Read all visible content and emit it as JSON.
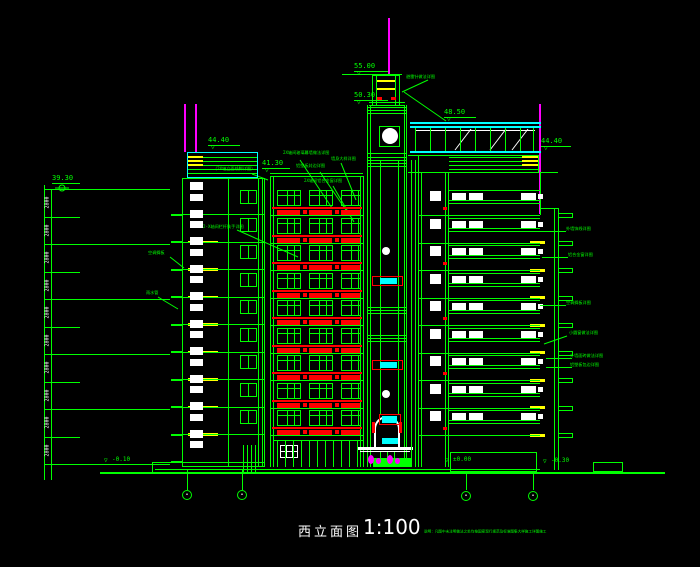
{
  "title": {
    "name": "西立面图",
    "scale": "1:100",
    "note": "说明：凡图中未注明做法之处均按国家现行规范及标准图集大样施工详图施工"
  },
  "levels": {
    "antenna_top": "55.00",
    "tower_roof": "50.30",
    "canopy": "48.50",
    "parapet_left": "44.40",
    "parapet_right": "44.40",
    "facade_top": "41.30",
    "ruler_top": "39.30",
    "ground": "±0.00",
    "plinth": "-0.10",
    "site": "-0.30"
  },
  "dims": {
    "floor_height": "2800"
  },
  "symbols": {
    "level_mark": "▽"
  },
  "grid_bubbles": [
    "•",
    "•",
    "•",
    "•"
  ],
  "annotations": {
    "tower": [
      "避雷针做法详图"
    ],
    "left": [
      "2X轴间玻璃幕墙做法详图",
      "墙身大样详图",
      "铝塑板封边详图",
      "（2X轴立面线脚详图）",
      "2X轴间铝合金窗详图",
      "2-X轴间栏杆扶手详图",
      "空调搁板",
      "雨水管"
    ],
    "right": [
      "外墙饰线详图",
      "铝合金窗详图",
      "空调搁板详图",
      "小圆窗做法详图",
      "外墙面砖做法详图",
      "铝塑板包边详图"
    ]
  },
  "colors": {
    "line": "#00ff00",
    "glass": "#00ffff",
    "panel": "#ff0000",
    "lightning": "#ff00ff",
    "band": "#ffff00",
    "text": "#ffffff"
  }
}
